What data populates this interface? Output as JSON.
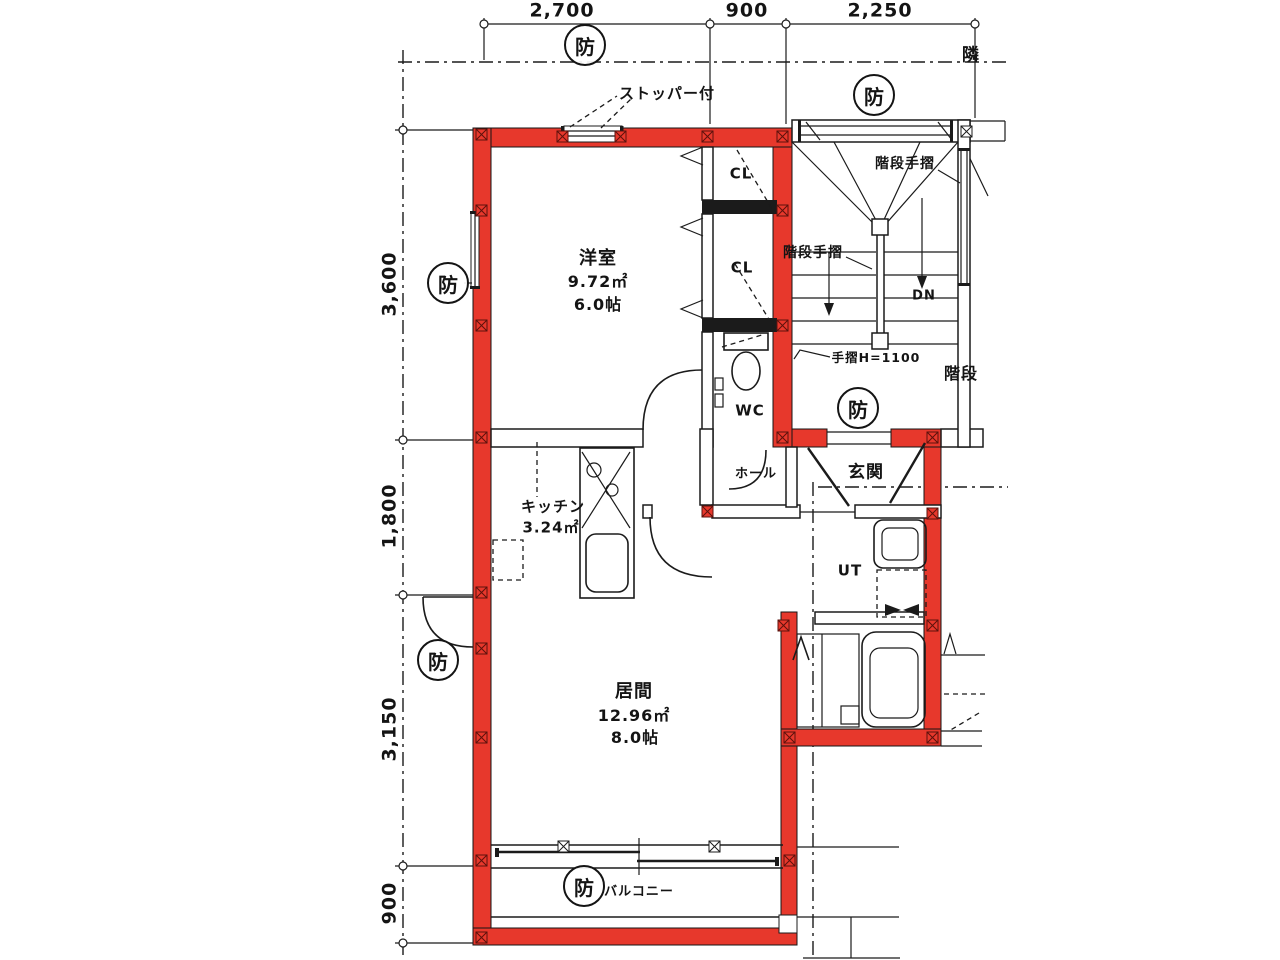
{
  "dimensions": {
    "top": [
      "2,700",
      "900",
      "2,250"
    ],
    "left": [
      "3,600",
      "1,800",
      "3,150",
      "900"
    ]
  },
  "rooms": {
    "western": {
      "name": "洋室",
      "area": "9.72㎡",
      "size": "6.0帖"
    },
    "kitchen": {
      "name": "キッチン",
      "area": "3.24㎡"
    },
    "living": {
      "name": "居間",
      "area": "12.96㎡",
      "size": "8.0帖"
    },
    "closet_upper": "CL",
    "closet_lower": "CL",
    "wc": "WC",
    "ut": "UT",
    "hall": "ホール",
    "entrance": "玄関",
    "balcony": "バルコニー",
    "stairs": "階段"
  },
  "annotations": {
    "fire_mark": "防",
    "stopper": "ストッパー付",
    "stair_handrail_upper": "階段手摺",
    "stair_handrail_lower": "階段手摺",
    "handrail_height": "手摺H=1100",
    "down": "DN",
    "neighbor": "隣"
  },
  "colors": {
    "fire_boundary": "#e7382c",
    "line": "#1b1b1b",
    "background": "#ffffff"
  }
}
